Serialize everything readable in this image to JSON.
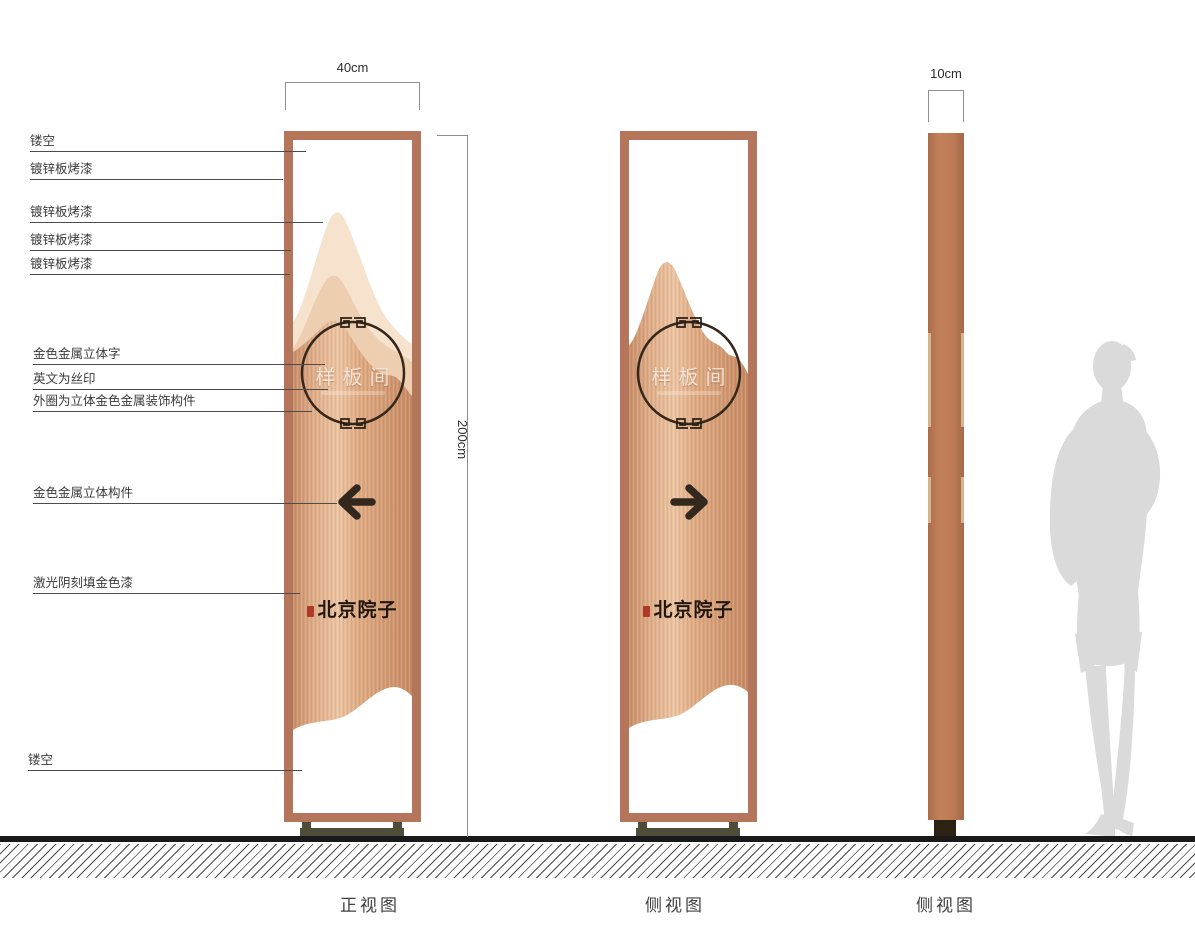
{
  "callouts": [
    {
      "label": "镂空"
    },
    {
      "label": "镀锌板烤漆"
    },
    {
      "label": "镀锌板烤漆"
    },
    {
      "label": "镀锌板烤漆"
    },
    {
      "label": "镀锌板烤漆"
    },
    {
      "label": "金色金属立体字"
    },
    {
      "label": "英文为丝印"
    },
    {
      "label": "外圈为立体金色金属装饰构件"
    },
    {
      "label": "金色金属立体构件"
    },
    {
      "label": "激光阴刻填金色漆"
    },
    {
      "label": "镂空"
    }
  ],
  "dimensions": {
    "width_front": "40cm",
    "height": "200cm",
    "width_side": "10cm"
  },
  "panels": {
    "front": {
      "caption": "正视图",
      "circle_text": "样板间",
      "brand": "北京院子",
      "arrow_direction": "left"
    },
    "back": {
      "caption": "侧视图",
      "circle_text": "样板间",
      "brand": "北京院子",
      "arrow_direction": "right"
    },
    "side": {
      "caption": "侧视图"
    }
  },
  "icons": {
    "arrow_left": "arrow-left-icon",
    "arrow_right": "arrow-right-icon",
    "seal": "red-seal-stamp-icon",
    "fret": "greek-key-ornament-icon",
    "silhouette": "human-scale-silhouette"
  },
  "colors": {
    "frame_copper": "#b5755a",
    "mountain_back": "#f6e2cd",
    "mountain_mid": "#eeceb0",
    "copper_body_light": "#ecc4a2",
    "copper_body_dark": "#c68a63",
    "slab": "#bd7a55",
    "slab_accent": "#d7b590",
    "base_olive": "#4d4d39",
    "ground_black": "#191919",
    "seal_red": "#b0392a",
    "accent_dark": "#33281e",
    "silhouette_gray": "#dadada"
  }
}
